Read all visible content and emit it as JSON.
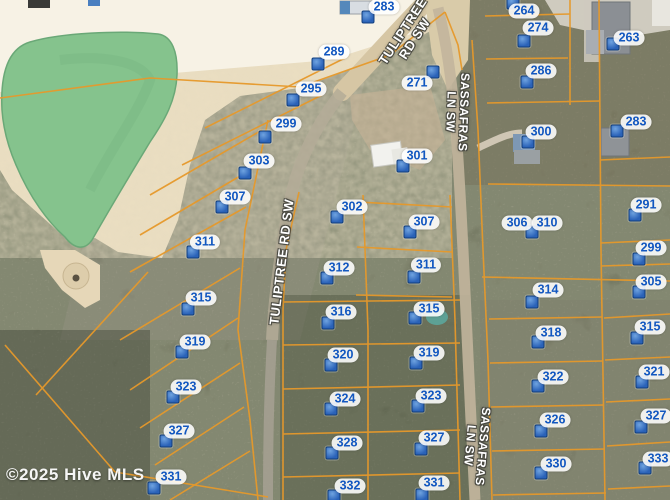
{
  "map": {
    "watermark": "©2025 Hive MLS",
    "colors": {
      "parcel_line": "#e6992b",
      "marker_blue": "#2f6fc3",
      "label_text": "#1257c0",
      "pond_green": "#85c38d",
      "sand": "#ecdfc2"
    },
    "parcels": [
      {
        "label": "283",
        "lx": 384,
        "ly": 7,
        "mx": 368,
        "my": 17
      },
      {
        "label": "289",
        "lx": 334,
        "ly": 52,
        "mx": 318,
        "my": 64
      },
      {
        "label": "295",
        "lx": 311,
        "ly": 89,
        "mx": 293,
        "my": 100
      },
      {
        "label": "299",
        "lx": 286,
        "ly": 124,
        "mx": 265,
        "my": 137
      },
      {
        "label": "303",
        "lx": 259,
        "ly": 161,
        "mx": 245,
        "my": 173
      },
      {
        "label": "307",
        "lx": 235,
        "ly": 197,
        "mx": 222,
        "my": 207
      },
      {
        "label": "311",
        "lx": 205,
        "ly": 242,
        "mx": 193,
        "my": 252
      },
      {
        "label": "315",
        "lx": 201,
        "ly": 298,
        "mx": 188,
        "my": 309
      },
      {
        "label": "319",
        "lx": 195,
        "ly": 342,
        "mx": 182,
        "my": 352
      },
      {
        "label": "323",
        "lx": 186,
        "ly": 387,
        "mx": 173,
        "my": 397
      },
      {
        "label": "327",
        "lx": 179,
        "ly": 431,
        "mx": 166,
        "my": 441
      },
      {
        "label": "331",
        "lx": 171,
        "ly": 477,
        "mx": 154,
        "my": 488
      },
      {
        "label": "271",
        "lx": 417,
        "ly": 83,
        "mx": 433,
        "my": 72
      },
      {
        "label": "301",
        "lx": 417,
        "ly": 156,
        "mx": 403,
        "my": 166
      },
      {
        "label": "302",
        "lx": 352,
        "ly": 207,
        "mx": 337,
        "my": 217
      },
      {
        "label": "307",
        "lx": 424,
        "ly": 222,
        "mx": 410,
        "my": 232
      },
      {
        "label": "311",
        "lx": 426,
        "ly": 265,
        "mx": 414,
        "my": 277
      },
      {
        "label": "312",
        "lx": 339,
        "ly": 268,
        "mx": 327,
        "my": 278
      },
      {
        "label": "316",
        "lx": 341,
        "ly": 312,
        "mx": 328,
        "my": 323
      },
      {
        "label": "315",
        "lx": 429,
        "ly": 309,
        "mx": 415,
        "my": 318
      },
      {
        "label": "320",
        "lx": 343,
        "ly": 355,
        "mx": 331,
        "my": 365
      },
      {
        "label": "319",
        "lx": 429,
        "ly": 353,
        "mx": 416,
        "my": 363
      },
      {
        "label": "324",
        "lx": 345,
        "ly": 399,
        "mx": 331,
        "my": 409
      },
      {
        "label": "323",
        "lx": 431,
        "ly": 396,
        "mx": 418,
        "my": 406
      },
      {
        "label": "328",
        "lx": 347,
        "ly": 443,
        "mx": 332,
        "my": 453
      },
      {
        "label": "327",
        "lx": 434,
        "ly": 438,
        "mx": 421,
        "my": 449
      },
      {
        "label": "332",
        "lx": 350,
        "ly": 486,
        "mx": 334,
        "my": 496
      },
      {
        "label": "331",
        "lx": 434,
        "ly": 483,
        "mx": 422,
        "my": 495
      },
      {
        "label": "264",
        "lx": 524,
        "ly": 11,
        "mx": 513,
        "my": 3
      },
      {
        "label": "274",
        "lx": 538,
        "ly": 28,
        "mx": 524,
        "my": 41
      },
      {
        "label": "286",
        "lx": 541,
        "ly": 71,
        "mx": 527,
        "my": 82
      },
      {
        "label": "300",
        "lx": 541,
        "ly": 132,
        "mx": 528,
        "my": 142
      },
      {
        "label": "306",
        "lx": 517,
        "ly": 223,
        "mx": 532,
        "my": 232
      },
      {
        "label": "310",
        "lx": 547,
        "ly": 223,
        "mx": null,
        "my": null
      },
      {
        "label": "314",
        "lx": 548,
        "ly": 290,
        "mx": 532,
        "my": 302
      },
      {
        "label": "318",
        "lx": 551,
        "ly": 333,
        "mx": 538,
        "my": 342
      },
      {
        "label": "322",
        "lx": 553,
        "ly": 377,
        "mx": 538,
        "my": 386
      },
      {
        "label": "326",
        "lx": 555,
        "ly": 420,
        "mx": 541,
        "my": 431
      },
      {
        "label": "330",
        "lx": 556,
        "ly": 464,
        "mx": 541,
        "my": 473
      },
      {
        "label": "263",
        "lx": 629,
        "ly": 38,
        "mx": 613,
        "my": 44
      },
      {
        "label": "283",
        "lx": 636,
        "ly": 122,
        "mx": 617,
        "my": 131
      },
      {
        "label": "291",
        "lx": 646,
        "ly": 205,
        "mx": 635,
        "my": 215
      },
      {
        "label": "299",
        "lx": 651,
        "ly": 248,
        "mx": 639,
        "my": 259
      },
      {
        "label": "305",
        "lx": 651,
        "ly": 282,
        "mx": 639,
        "my": 292
      },
      {
        "label": "315",
        "lx": 650,
        "ly": 327,
        "mx": 637,
        "my": 338
      },
      {
        "label": "321",
        "lx": 654,
        "ly": 372,
        "mx": 642,
        "my": 382
      },
      {
        "label": "327",
        "lx": 656,
        "ly": 416,
        "mx": 641,
        "my": 427
      },
      {
        "label": "333",
        "lx": 658,
        "ly": 459,
        "mx": 645,
        "my": 468
      }
    ],
    "road_labels": [
      {
        "name": "tuliptree-rd-sw",
        "lines": [
          "TULIPTREE",
          "RD SW"
        ],
        "x": 409,
        "y": 35,
        "rot": -57,
        "size": 13
      },
      {
        "name": "tuliptree-rd-sw",
        "lines": [
          "TULIPTREE RD SW"
        ],
        "x": 282,
        "y": 262,
        "rot": -83,
        "size": 13
      },
      {
        "name": "sassafras-ln-sw",
        "lines": [
          "SASSAFRAS",
          "LN SW"
        ],
        "x": 457,
        "y": 112,
        "rot": 92,
        "size": 12
      },
      {
        "name": "sassafras-ln-sw",
        "lines": [
          "SASSAFRAS",
          "LN SW"
        ],
        "x": 476,
        "y": 446,
        "rot": 95,
        "size": 12
      }
    ]
  }
}
